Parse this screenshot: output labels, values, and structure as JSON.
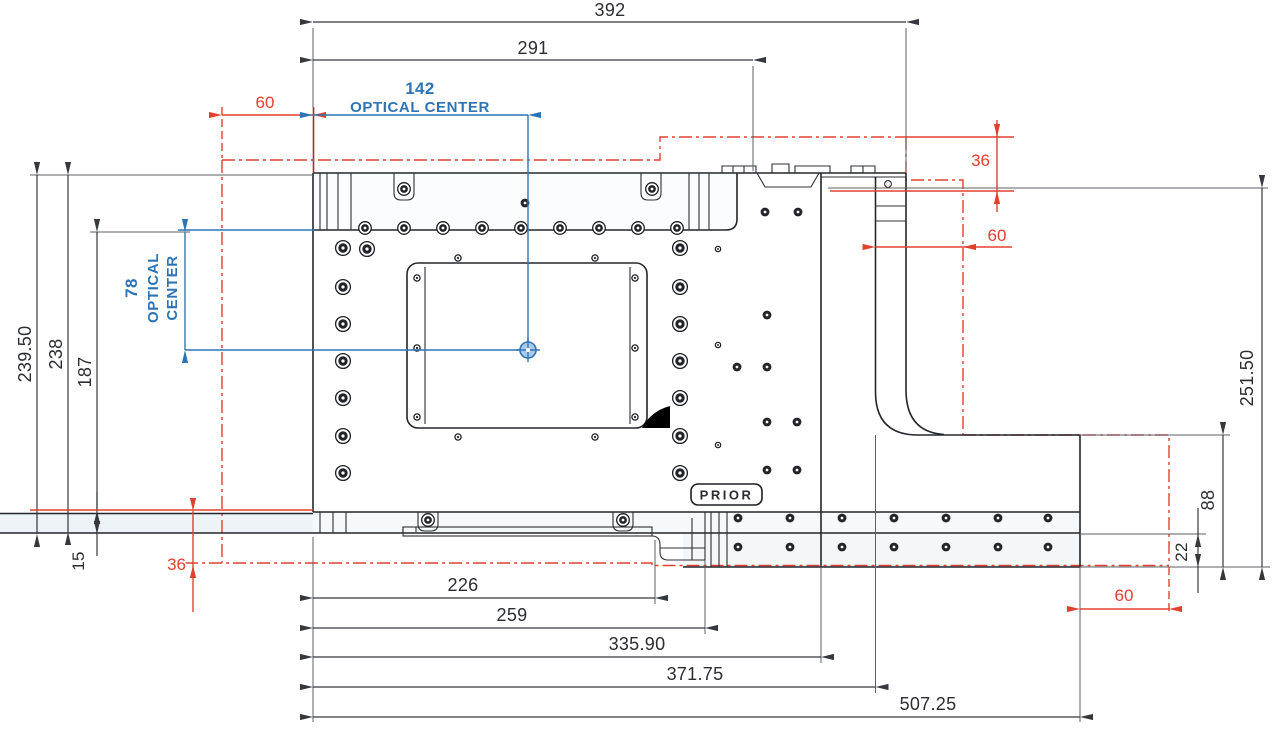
{
  "drawing": {
    "brand_label": "PRIOR",
    "colors": {
      "machine_line": "#23262b",
      "dimension_line": "#35383d",
      "travel_red": "#e2402f",
      "optical_blue": "#2e74b5"
    },
    "dimensions": {
      "top_overall": "392",
      "top_inner": "291",
      "optical_center_x": "142",
      "optical_center_x_label": "OPTICAL CENTER",
      "optical_center_y": "78",
      "optical_center_y_label_line1": "OPTICAL",
      "optical_center_y_label_line2": "CENTER",
      "left_outer": "239.50",
      "left_inner": "238",
      "left_aperture": "187",
      "left_plate_step": "15",
      "right_overall": "251.50",
      "right_arm_depth": "88",
      "right_arm_step": "22",
      "bottom": [
        "226",
        "259",
        "335.90",
        "371.75",
        "507.25"
      ],
      "travel_top_left": "60",
      "travel_top_right": "36",
      "travel_right": "60",
      "travel_bottom_left": "36",
      "travel_bottom_right": "60"
    }
  }
}
